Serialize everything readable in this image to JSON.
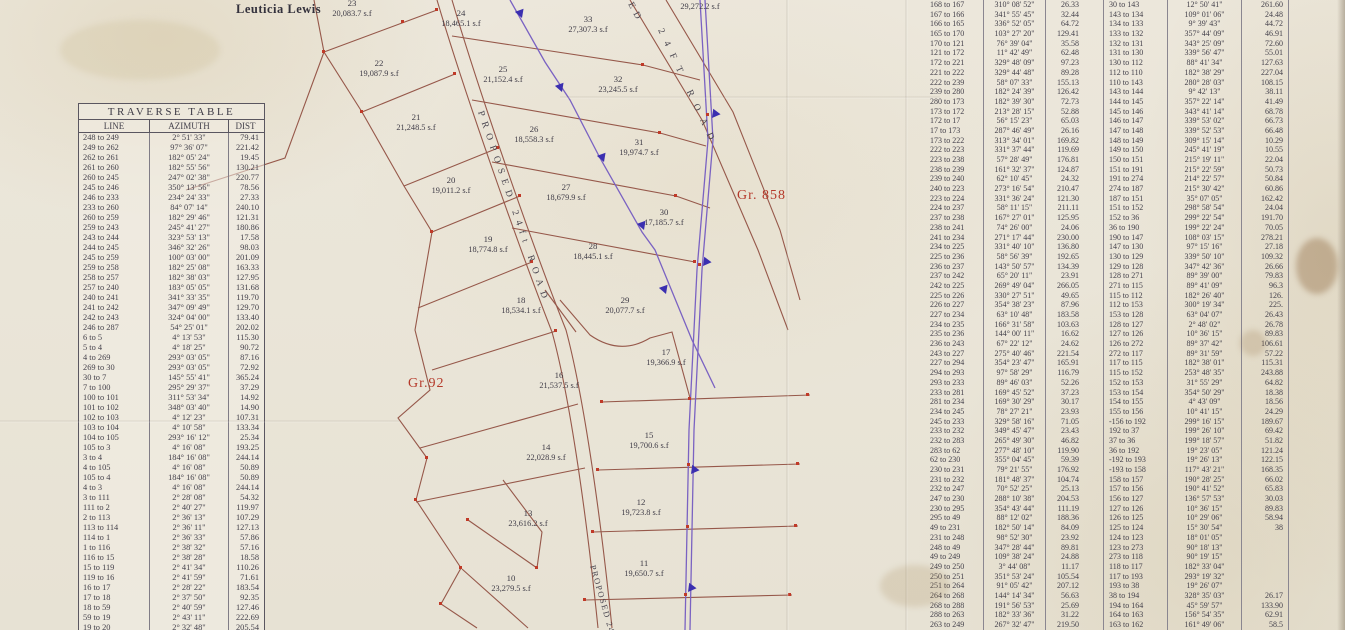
{
  "colors": {
    "red_label": "#b5392a",
    "purple_ink": "#7a62c2",
    "brown_ink": "#96584a",
    "paper": "#eae5d8"
  },
  "left_table": {
    "title": "TRAVERSE  TABLE",
    "headers": [
      "LINE",
      "AZIMUTH",
      "DIST"
    ],
    "rows": [
      [
        "248 to 249",
        "2° 51' 33\"",
        "79.41"
      ],
      [
        "249 to 262",
        "97° 36' 07\"",
        "221.42"
      ],
      [
        "262 to 261",
        "182° 05' 24\"",
        "19.45"
      ],
      [
        "261 to 260",
        "182° 55' 56\"",
        "130.21"
      ],
      [
        "260 to 245",
        "247° 02' 38\"",
        "220.77"
      ],
      [
        "245 to 246",
        "350° 13' 56\"",
        "78.56"
      ],
      [
        "246 to 233",
        "234° 24' 33\"",
        "27.33"
      ],
      [
        "233 to 260",
        "84° 07' 14\"",
        "240.10"
      ],
      [
        "260 to 259",
        "182° 29' 46\"",
        "121.31"
      ],
      [
        "259 to 243",
        "245° 41' 27\"",
        "180.86"
      ],
      [
        "243 to 244",
        "323° 53' 13\"",
        "17.58"
      ],
      [
        "244 to 245",
        "346° 32' 26\"",
        "98.03"
      ],
      [
        "245 to 259",
        "100° 03' 00\"",
        "201.09"
      ],
      [
        "259 to 258",
        "182° 25' 08\"",
        "163.33"
      ],
      [
        "258 to 257",
        "182° 38' 03\"",
        "127.95"
      ],
      [
        "257 to 240",
        "183° 05' 05\"",
        "131.68"
      ],
      [
        "240 to 241",
        "341° 33' 35\"",
        "119.70"
      ],
      [
        "241 to 242",
        "347° 09' 49\"",
        "129.70"
      ],
      [
        "242 to 243",
        "324° 04' 00\"",
        "133.40"
      ],
      [
        "246 to 287",
        "54° 25' 01\"",
        "202.02"
      ],
      [
        "6 to 5",
        "4° 13' 53\"",
        "115.30"
      ],
      [
        "5 to 4",
        "4° 18' 25\"",
        "90.72"
      ],
      [
        "4 to 269",
        "293° 03' 05\"",
        "87.16"
      ],
      [
        "269 to 30",
        "293° 03' 05\"",
        "72.92"
      ],
      [
        "30 to 7",
        "145° 55' 41\"",
        "365.24"
      ],
      [
        "7 to 100",
        "295° 29' 37\"",
        "37.29"
      ],
      [
        "100 to 101",
        "311° 53' 34\"",
        "14.92"
      ],
      [
        "101 to 102",
        "348° 03' 40\"",
        "14.90"
      ],
      [
        "102 to 103",
        "4° 12' 23\"",
        "107.31"
      ],
      [
        "103 to 104",
        "4° 10' 58\"",
        "133.34"
      ],
      [
        "104 to 105",
        "293° 16' 12\"",
        "25.34"
      ],
      [
        "105 to 3",
        "4° 16' 08\"",
        "193.25"
      ],
      [
        "3 to 4",
        "184° 16' 08\"",
        "244.14"
      ],
      [
        "4 to 105",
        "4° 16' 08\"",
        "50.89"
      ],
      [
        "105 to 4",
        "184° 16' 08\"",
        "50.89"
      ],
      [
        "4 to 3",
        "4° 16' 08\"",
        "244.14"
      ],
      [
        "3 to 111",
        "2° 28' 08\"",
        "54.32"
      ],
      [
        "111 to 2",
        "2° 40' 27\"",
        "119.97"
      ],
      [
        "2 to 113",
        "2° 36' 13\"",
        "107.29"
      ],
      [
        "113 to 114",
        "2° 36' 11\"",
        "127.13"
      ],
      [
        "114 to 1",
        "2° 36' 33\"",
        "57.86"
      ],
      [
        "1 to 116",
        "2° 38' 32\"",
        "57.16"
      ],
      [
        "116 to 15",
        "2° 38' 28\"",
        "18.58"
      ],
      [
        "15 to 119",
        "2° 41' 34\"",
        "110.26"
      ],
      [
        "119 to 16",
        "2° 41' 59\"",
        "71.61"
      ],
      [
        "16 to 17",
        "2° 28' 22\"",
        "183.54"
      ],
      [
        "17 to 18",
        "2° 37' 50\"",
        "92.35"
      ],
      [
        "18 to 59",
        "2° 40' 59\"",
        "127.46"
      ],
      [
        "59 to 19",
        "2° 43' 11\"",
        "222.69"
      ],
      [
        "19 to 20",
        "2° 32' 48\"",
        "205.54"
      ],
      [
        "20 to 21",
        "2° 33' 37\"",
        "221.58"
      ]
    ]
  },
  "right_table_1": {
    "rows": [
      [
        "168 to 167",
        "310° 08' 52\"",
        "26.33"
      ],
      [
        "167 to 166",
        "341° 55' 45\"",
        "32.44"
      ],
      [
        "166 to 165",
        "336° 52' 05\"",
        "64.72"
      ],
      [
        "165 to 170",
        "103° 27' 20\"",
        "129.41"
      ],
      [
        "170 to 121",
        "76° 39' 04\"",
        "35.58"
      ],
      [
        "121 to 172",
        "11° 42' 49\"",
        "62.48"
      ],
      [
        "172 to 221",
        "329° 48' 09\"",
        "97.23"
      ],
      [
        "221 to 222",
        "329° 44' 48\"",
        "89.28"
      ],
      [
        "222 to 239",
        "58° 07' 33\"",
        "155.13"
      ],
      [
        "239 to 280",
        "182° 24' 39\"",
        "126.42"
      ],
      [
        "280 to 173",
        "182° 39' 30\"",
        "72.73"
      ],
      [
        "173 to 172",
        "213° 28' 15\"",
        "52.88"
      ],
      [
        "172 to 17",
        "56° 15' 23\"",
        "65.03"
      ],
      [
        "17 to 173",
        "287° 46' 49\"",
        "26.16"
      ],
      [
        "173 to 222",
        "313° 34' 01\"",
        "169.82"
      ],
      [
        "222 to 223",
        "331° 37' 44\"",
        "119.69"
      ],
      [
        "223 to 238",
        "57° 28' 49\"",
        "176.81"
      ],
      [
        "238 to 239",
        "161° 32' 37\"",
        "124.87"
      ],
      [
        "239 to 240",
        "62° 10' 45\"",
        "24.32"
      ],
      [
        "240 to 223",
        "273° 16' 54\"",
        "210.47"
      ],
      [
        "223 to 224",
        "331° 36' 24\"",
        "121.30"
      ],
      [
        "224 to 237",
        "58° 11' 15\"",
        "211.11"
      ],
      [
        "237 to 238",
        "167° 27' 01\"",
        "125.95"
      ],
      [
        "238 to 241",
        "74° 26' 00\"",
        "24.06"
      ],
      [
        "241 to 234",
        "271° 17' 44\"",
        "230.00"
      ],
      [
        "234 to 225",
        "331° 40' 10\"",
        "136.80"
      ],
      [
        "225 to 236",
        "58° 56' 39\"",
        "192.65"
      ],
      [
        "236 to 237",
        "143° 50' 57\"",
        "134.39"
      ],
      [
        "237 to 242",
        "65° 20' 11\"",
        "23.91"
      ],
      [
        "242 to 225",
        "269° 49' 04\"",
        "266.05"
      ],
      [
        "225 to 226",
        "330° 27' 51\"",
        "49.65"
      ],
      [
        "226 to 227",
        "354° 38' 23\"",
        "87.96"
      ],
      [
        "227 to 234",
        "63° 10' 48\"",
        "183.58"
      ],
      [
        "234 to 235",
        "166° 31' 58\"",
        "103.63"
      ],
      [
        "235 to 236",
        "144° 00' 11\"",
        "16.62"
      ],
      [
        "236 to 243",
        "67° 22' 12\"",
        "24.62"
      ],
      [
        "243 to 227",
        "275° 40' 46\"",
        "221.54"
      ],
      [
        "227 to 294",
        "354° 23' 47\"",
        "165.91"
      ],
      [
        "294 to 293",
        "97° 58' 29\"",
        "116.79"
      ],
      [
        "293 to 233",
        "89° 46' 03\"",
        "52.26"
      ],
      [
        "233 to 281",
        "169° 45' 52\"",
        "37.23"
      ],
      [
        "281 to 234",
        "169° 30' 29\"",
        "30.17"
      ],
      [
        "234 to 245",
        "78° 27' 21\"",
        "23.93"
      ],
      [
        "245 to 233",
        "329° 58' 16\"",
        "71.05"
      ],
      [
        "233 to 232",
        "349° 45' 47\"",
        "23.43"
      ],
      [
        "232 to 283",
        "265° 49' 30\"",
        "46.82"
      ],
      [
        "283 to 62",
        "277° 48' 10\"",
        "119.90"
      ],
      [
        "62 to 230",
        "355° 04' 45\"",
        "59.39"
      ],
      [
        "230 to 231",
        "79° 21' 55\"",
        "176.92"
      ],
      [
        "231 to 232",
        "181° 48' 37\"",
        "104.74"
      ],
      [
        "232 to 247",
        "70° 52' 25\"",
        "25.13"
      ],
      [
        "247 to 230",
        "288° 10' 38\"",
        "204.53"
      ],
      [
        "230 to 295",
        "354° 43' 44\"",
        "111.19"
      ],
      [
        "295 to 49",
        "88° 12' 02\"",
        "188.36"
      ],
      [
        "49 to 231",
        "182° 50' 14\"",
        "84.09"
      ],
      [
        "231 to 248",
        "98° 52' 30\"",
        "23.92"
      ],
      [
        "248 to 49",
        "347° 28' 44\"",
        "89.81"
      ],
      [
        "49 to 249",
        "109° 38' 24\"",
        "24.88"
      ],
      [
        "249 to 250",
        "3° 44' 08\"",
        "11.17"
      ],
      [
        "250 to 251",
        "351° 53' 24\"",
        "105.54"
      ],
      [
        "251 to 264",
        "91° 05' 42\"",
        "207.12"
      ],
      [
        "264 to 268",
        "144° 14' 34\"",
        "56.63"
      ],
      [
        "268 to 288",
        "191° 56' 53\"",
        "25.69"
      ],
      [
        "288 to 263",
        "182° 33' 36\"",
        "31.22"
      ],
      [
        "263 to 249",
        "267° 32' 47\"",
        "219.50"
      ]
    ]
  },
  "right_table_2": {
    "rows": [
      [
        "30 to 143",
        "12° 50' 41\"",
        "261.60"
      ],
      [
        "143 to 134",
        "109° 01' 06\"",
        "24.48"
      ],
      [
        "134 to 133",
        "9° 39' 43\"",
        "44.72"
      ],
      [
        "133 to 132",
        "357° 44' 09\"",
        "46.91"
      ],
      [
        "132 to 131",
        "343° 25' 09\"",
        "72.60"
      ],
      [
        "131 to 130",
        "339° 56' 47\"",
        "55.01"
      ],
      [
        "130 to 112",
        "88° 41' 34\"",
        "127.63"
      ],
      [
        "112 to 110",
        "182° 38' 29\"",
        "227.04"
      ],
      [
        "110 to 143",
        "280° 28' 03\"",
        "108.15"
      ],
      [
        "143 to 144",
        "9° 42' 13\"",
        "38.11"
      ],
      [
        "144 to 145",
        "357° 22' 14\"",
        "41.49"
      ],
      [
        "145 to 146",
        "343° 41' 14\"",
        "68.78"
      ],
      [
        "146 to 147",
        "339° 53' 02\"",
        "66.73"
      ],
      [
        "147 to 148",
        "339° 52' 53\"",
        "66.48"
      ],
      [
        "148 to 149",
        "309° 15' 14\"",
        "10.29"
      ],
      [
        "149 to 150",
        "245° 41' 19\"",
        "10.55"
      ],
      [
        "150 to 151",
        "215° 19' 11\"",
        "22.04"
      ],
      [
        "151 to 191",
        "215° 22' 59\"",
        "50.73"
      ],
      [
        "191 to 274",
        "214° 22' 57\"",
        "50.84"
      ],
      [
        "274 to 187",
        "215° 30' 42\"",
        "60.86"
      ],
      [
        "187 to 151",
        "35° 07' 05\"",
        "162.42"
      ],
      [
        "151 to 152",
        "298° 58' 54\"",
        "24.04"
      ],
      [
        "152 to 36",
        "299° 22' 54\"",
        "191.70"
      ],
      [
        "36 to 190",
        "199° 22' 24\"",
        "70.05"
      ],
      [
        "190 to 147",
        "108° 03' 15\"",
        "278.21"
      ],
      [
        "147 to 130",
        "97° 15' 16\"",
        "27.18"
      ],
      [
        "130 to 129",
        "339° 50' 10\"",
        "109.32"
      ],
      [
        "129 to 128",
        "347° 42' 36\"",
        "26.66"
      ],
      [
        "128 to 271",
        "89° 39' 00\"",
        "79.83"
      ],
      [
        "271 to 115",
        "89° 41' 09\"",
        "96.3"
      ],
      [
        "115 to 112",
        "182° 26' 40\"",
        "126."
      ],
      [
        "112 to 153",
        "300° 19' 34\"",
        "225."
      ],
      [
        "153 to 128",
        "63° 04' 07\"",
        "26.43"
      ],
      [
        "128 to 127",
        "2° 48' 02\"",
        "26.78"
      ],
      [
        "127 to 126",
        "10° 36' 15\"",
        "89.83"
      ],
      [
        "126 to 272",
        "89° 37' 42\"",
        "106.61"
      ],
      [
        "272 to 117",
        "89° 31' 59\"",
        "57.22"
      ],
      [
        "117 to 115",
        "182° 38' 01\"",
        "115.31"
      ],
      [
        "115 to 152",
        "253° 48' 35\"",
        "243.88"
      ],
      [
        "152 to 153",
        "31° 55' 29\"",
        "64.82"
      ],
      [
        "153 to 154",
        "354° 50' 29\"",
        "18.38"
      ],
      [
        "154 to 155",
        "4° 43' 09\"",
        "18.56"
      ],
      [
        "155 to 156",
        "10° 41' 15\"",
        "24.29"
      ],
      [
        "-156 to 192",
        "299° 16' 15\"",
        "189.67"
      ],
      [
        "192 to 37",
        "199° 26' 10\"",
        "69.42"
      ],
      [
        "37 to 36",
        "199° 18' 57\"",
        "51.82"
      ],
      [
        "36 to 192",
        "19° 23' 05\"",
        "121.24"
      ],
      [
        "-192 to 193",
        "19° 26' 13\"",
        "122.15"
      ],
      [
        "-193 to 158",
        "117° 43' 21\"",
        "168.35"
      ],
      [
        "158 to 157",
        "190° 28' 25\"",
        "66.02"
      ],
      [
        "157 to 156",
        "190° 41' 52\"",
        "65.83"
      ],
      [
        "156 to 127",
        "136° 57' 53\"",
        "30.03"
      ],
      [
        "127 to 126",
        "10° 36' 15\"",
        "89.83"
      ],
      [
        "126 to 125",
        "10° 29' 06\"",
        "58.94"
      ],
      [
        "125 to 124",
        "15° 30' 54\"",
        "38"
      ],
      [
        "124 to 123",
        "18° 01' 05\"",
        ""
      ],
      [
        "123 to 273",
        "90° 18' 13\"",
        ""
      ],
      [
        "273 to 118",
        "90° 19' 15\"",
        ""
      ],
      [
        "118 to 117",
        "182° 33' 04\"",
        ""
      ],
      [
        "117 to 193",
        "293° 19' 32\"",
        ""
      ],
      [
        "193 to 38",
        "19° 26' 07\"",
        ""
      ],
      [
        "38 to 194",
        "328° 35' 03\"",
        "26.17"
      ],
      [
        "194 to 164",
        "45° 59' 57\"",
        "133.90"
      ],
      [
        "164 to 163",
        "156° 54' 35\"",
        "62.91"
      ],
      [
        "163 to 162",
        "161° 49' 06\"",
        "58.5"
      ]
    ]
  },
  "map": {
    "owner_name": "Leuticia Lewis",
    "grant_label_1": "Gr.92",
    "grant_label_2": "Gr. 858",
    "road_labels": {
      "main_road": "PROPOSED 24ft ROAD",
      "top_right_fragment": "ED",
      "top_right_road": "24FT ROAD",
      "bottom_road": "PROPOSED 24FT"
    },
    "partial_lot_area": "29,272.2 s.f",
    "lots": [
      {
        "num": "23",
        "area": "20,083.7 s.f"
      },
      {
        "num": "24",
        "area": "18,465.1 s.f"
      },
      {
        "num": "33",
        "area": "27,307.3 s.f"
      },
      {
        "num": "22",
        "area": "19,087.9 s.f"
      },
      {
        "num": "25",
        "area": "21,152.4 s.f"
      },
      {
        "num": "32",
        "area": "23,245.5 s.f"
      },
      {
        "num": "21",
        "area": "21,248.5 s.f"
      },
      {
        "num": "26",
        "area": "18,558.3 s.f"
      },
      {
        "num": "31",
        "area": "19,974.7 s.f"
      },
      {
        "num": "20",
        "area": "19,011.2 s.f"
      },
      {
        "num": "27",
        "area": "18,679.9 s.f"
      },
      {
        "num": "30",
        "area": "17,185.7 s.f"
      },
      {
        "num": "19",
        "area": "18,774.8 s.f"
      },
      {
        "num": "28",
        "area": "18,445.1 s.f"
      },
      {
        "num": "18",
        "area": "18,534.1 s.f"
      },
      {
        "num": "29",
        "area": "20,077.7 s.f"
      },
      {
        "num": "17",
        "area": "19,366.9 s.f"
      },
      {
        "num": "16",
        "area": "21,537.5 s.f"
      },
      {
        "num": "15",
        "area": "19,700.6 s.f"
      },
      {
        "num": "14",
        "area": "22,028.9 s.f"
      },
      {
        "num": "13",
        "area": "23,616.2 s.f"
      },
      {
        "num": "12",
        "area": "19,723.8 s.f"
      },
      {
        "num": "11",
        "area": "19,650.7 s.f"
      },
      {
        "num": "10",
        "area": "23,279.5 s.f"
      }
    ]
  }
}
